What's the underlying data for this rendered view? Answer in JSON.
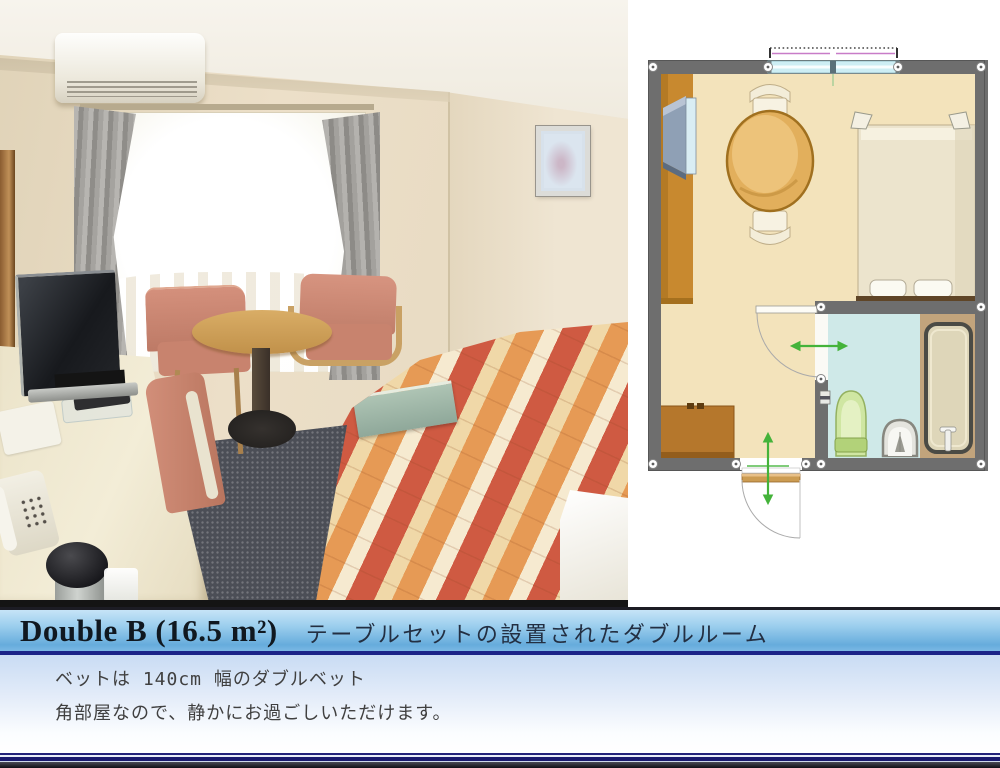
{
  "banner": {
    "title_en": "Double B (16.5 m²)",
    "title_ja": "テーブルセットの設置されたダブルルーム"
  },
  "description": {
    "line1": "ベットは 140cm 幅のダブルベット",
    "line2": "角部屋なので、静かにお過ごしいただけます。"
  },
  "colors": {
    "banner_border_bottom": "#1a2388",
    "banner_gradient_top": "#c6e4f7",
    "banner_gradient_bottom": "#66acdc",
    "description_gradient_top": "#c9dcf4",
    "floorplan_wall": "#6e6e6e",
    "floorplan_floor": "#f3e3bb",
    "floorplan_bathroom_floor": "#cfe9e8",
    "floorplan_arrow_green": "#44b33a",
    "quilt_red": "#cf5a42",
    "quilt_orange": "#e69a55",
    "quilt_cream": "#f0d8a8"
  }
}
